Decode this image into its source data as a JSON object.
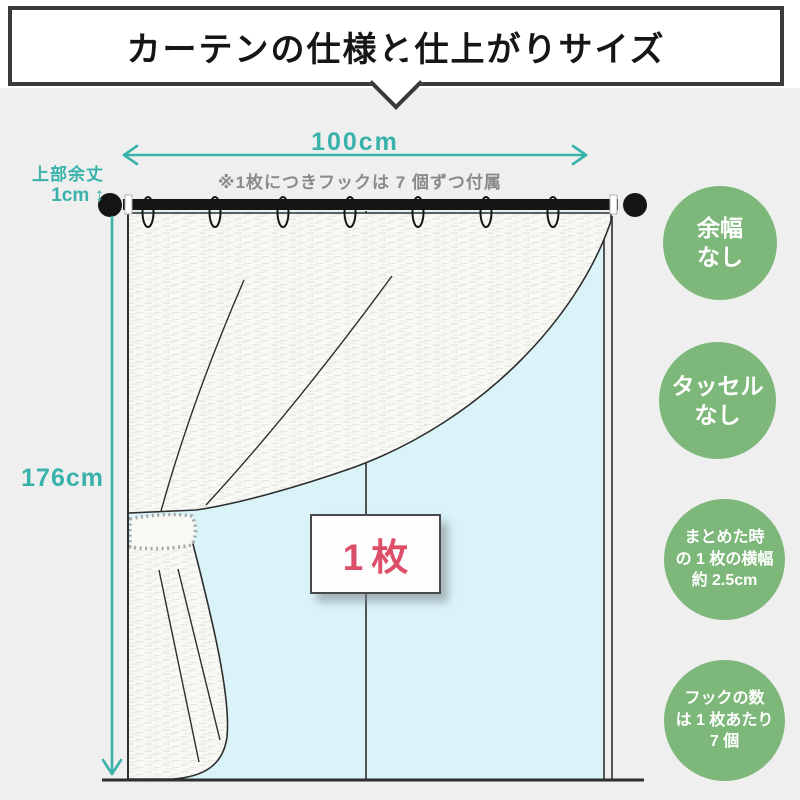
{
  "header": {
    "title": "カーテンの仕様と仕上がりサイズ"
  },
  "diagram": {
    "width_label": "100cm",
    "hook_note": "※1枚につきフックは 7 個ずつ付属",
    "top_allowance_label": "上部余丈",
    "top_allowance_value": "1cm ↕",
    "height_label": "176cm",
    "panel_count_label": "1枚",
    "hook_count": 7,
    "colors": {
      "measure_teal": "#38b2aa",
      "badge_green": "#7db87a",
      "panel_pink": "#dd4e68",
      "curtain_blue": "#d9f3f8"
    }
  },
  "badges": [
    {
      "lines": [
        "余幅",
        "なし"
      ]
    },
    {
      "lines": [
        "タッセル",
        "なし"
      ]
    },
    {
      "lines": [
        "まとめた時",
        "の 1 枚の横幅",
        "約 2.5cm"
      ]
    },
    {
      "lines": [
        "フックの数",
        "は 1 枚あたり",
        "7 個"
      ]
    }
  ]
}
